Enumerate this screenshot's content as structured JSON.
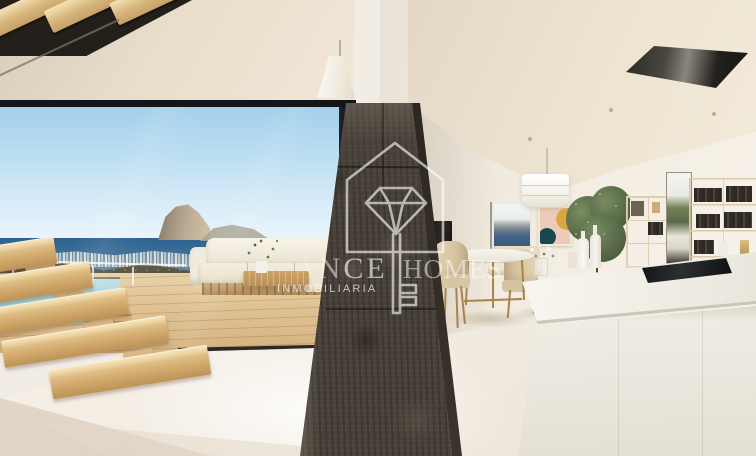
{
  "watermark": {
    "logo_icon": "house-diamond-key-icon",
    "brand_fragment_left": "ANCE",
    "brand_fragment_right": "HOMES",
    "subtitle": "INMOBILIARIA",
    "color": "#ffffff"
  },
  "palette": {
    "ceiling_cream": "#e9dfce",
    "wall_white": "#f2ece2",
    "sky_top": "#a3cfeb",
    "sky_horizon": "#eef7fb",
    "sea_blue": "#2e628f",
    "rock_tan": "#bcab93",
    "hills_olive": "#5a5643",
    "deck_wood": "#dec39a",
    "pool_aqua": "#9fd2da",
    "stair_oak": "#dfbd85",
    "stone_pillar": "#49423a",
    "island_white": "#f1eee6",
    "hob_black": "#141619",
    "chair_beige": "#d8c5a4",
    "brass_gold": "#a8834a",
    "pillow_teal": "#1d575c",
    "pillow_mustard": "#c7a139",
    "plant_green": "#556746",
    "floor_ivory": "#f2ede5"
  }
}
